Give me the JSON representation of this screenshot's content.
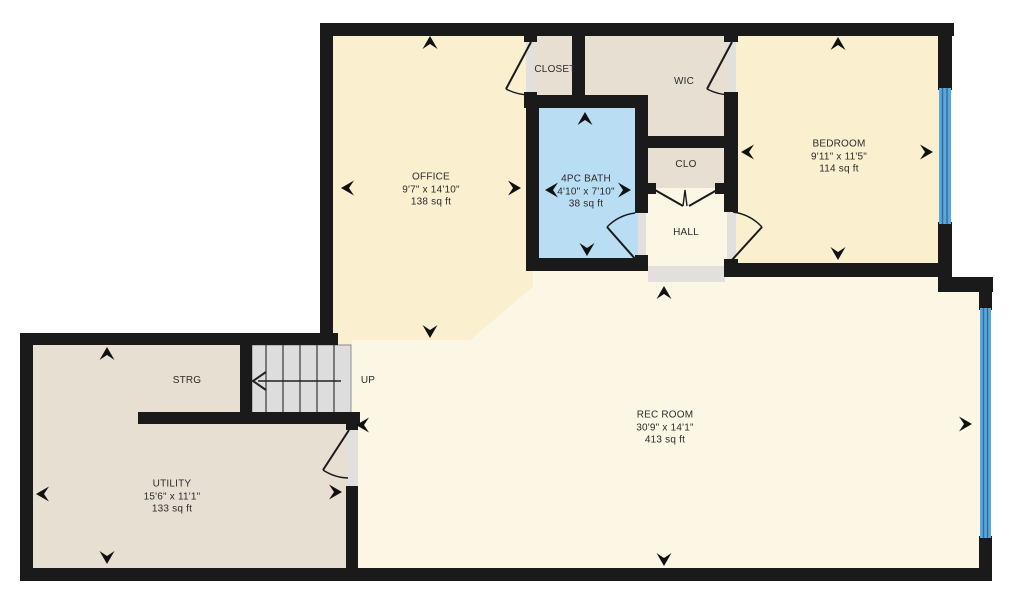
{
  "document": {
    "type": "floor-plan"
  },
  "rooms": {
    "office": {
      "name": "OFFICE",
      "dims": "9'7\" x 14'10\"",
      "area": "138 sq ft"
    },
    "closet": {
      "name": "CLOSET"
    },
    "wic": {
      "name": "WIC"
    },
    "bedroom": {
      "name": "BEDROOM",
      "dims": "9'11\" x 11'5\"",
      "area": "114 sq ft"
    },
    "bath": {
      "name": "4PC BATH",
      "dims": "4'10\" x 7'10\"",
      "area": "38 sq ft"
    },
    "clo": {
      "name": "CLO"
    },
    "hall": {
      "name": "HALL"
    },
    "rec_room": {
      "name": "REC ROOM",
      "dims": "30'9\" x 14'1\"",
      "area": "413 sq ft"
    },
    "strg": {
      "name": "STRG"
    },
    "utility": {
      "name": "UTILITY",
      "dims": "15'6\" x 11'1\"",
      "area": "133 sq ft"
    }
  },
  "stairs": {
    "label": "UP"
  },
  "colors": {
    "wall": "#1a1a1a",
    "room_cream": "#FAEFCF",
    "room_cream_light": "#FCF7E4",
    "room_beige": "#E7DFD2",
    "bath_blue": "#B9DDF3",
    "stairs_gray": "#DDDDDD",
    "threshold_gray": "#E2E0DC",
    "window_blue": "#5BA7D9",
    "window_line": "#2A6DA0",
    "text": "#2b2b2b",
    "background": "#FFFFFF"
  }
}
